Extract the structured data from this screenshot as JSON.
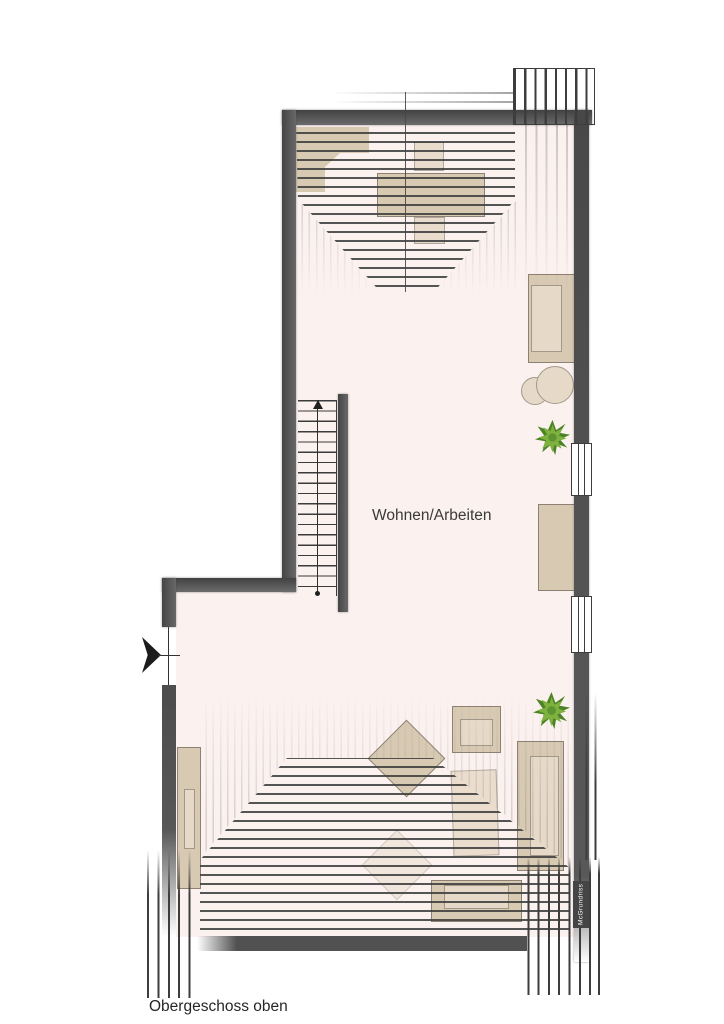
{
  "plan": {
    "floor_label": "Obergeschoss oben",
    "room_label": "Wohnen/Arbeiten",
    "watermark_label": "McGrundriss",
    "stairs": {
      "steps": 19,
      "direction": "up"
    },
    "colors": {
      "floor": "#fbf1ef",
      "wall": "#515151",
      "line": "#3d3d3d",
      "furn": "#d8c9b3",
      "furn_light": "#e7d9c7",
      "furn_edge": "#8c8173",
      "plant_dark": "#4c8326",
      "plant_light": "#7fb13f",
      "text": "#3a3a3a"
    },
    "furniture": [
      "corner-desk",
      "office-chair",
      "desk",
      "office-chair",
      "sofa",
      "side-table",
      "sideboard",
      "armchair",
      "lounge-chair",
      "sofa",
      "table",
      "bench",
      "wardrobe",
      "plant",
      "plant"
    ]
  }
}
